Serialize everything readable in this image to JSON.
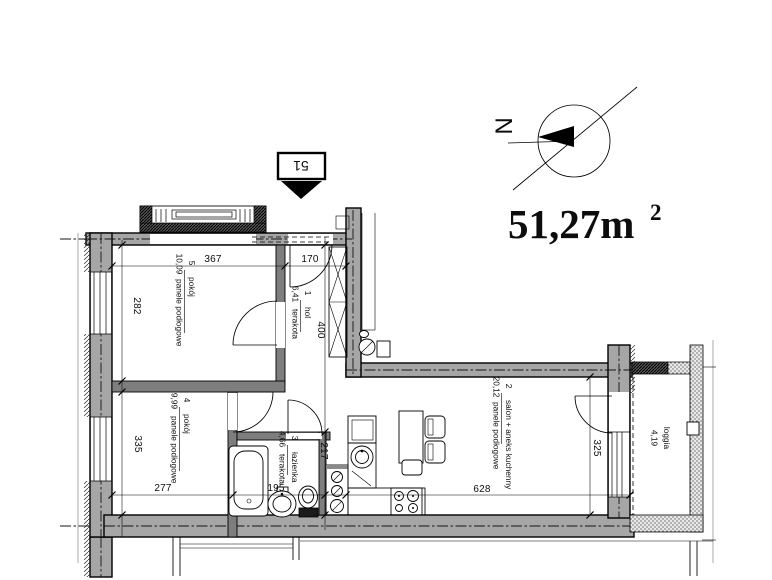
{
  "header": {
    "area_value": "51,27m",
    "area_sup": "2",
    "unit_number": "51",
    "compass_letter": "N"
  },
  "rooms": {
    "room5": {
      "number": "5",
      "name": "pokój",
      "area": "10,09",
      "floor": "panele podłogowe"
    },
    "hall": {
      "number": "1",
      "name": "hol",
      "area": "6,41",
      "floor": "terakota"
    },
    "room4": {
      "number": "4",
      "name": "pokój",
      "area": "9,99",
      "floor": "panele podłogowe"
    },
    "bathroom": {
      "number": "3",
      "name": "łazienka",
      "area": "4,66",
      "floor": "terakota"
    },
    "living": {
      "number": "2",
      "name": "salon + aneks kuchenny",
      "area": "20,12",
      "floor": "panele podłogowe"
    },
    "loggia": {
      "name": "loggia",
      "area": "4,19"
    }
  },
  "dimensions": {
    "room5_width": "367",
    "hall_width": "170",
    "room5_depth": "282",
    "hall_depth": "400",
    "room4_depth": "335",
    "room4_width": "277",
    "bathroom_width": "195",
    "bathroom_depth": "217",
    "living_width": "628",
    "living_depth": "325"
  },
  "colors": {
    "wall_fill": "#a6a6a6",
    "interior_wall_fill": "#7e7e7e",
    "line": "#000000",
    "background": "#ffffff"
  }
}
